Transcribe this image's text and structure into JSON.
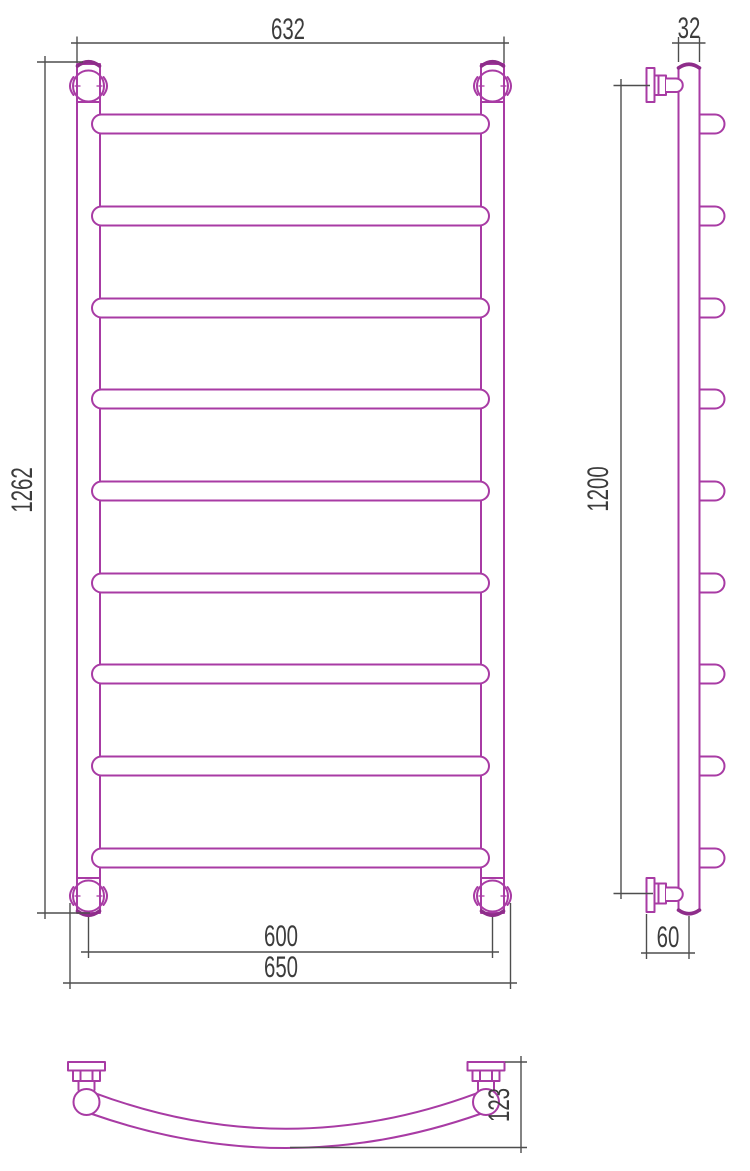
{
  "drawing": {
    "type": "technical-dimension-drawing",
    "rung_count": 9,
    "colors": {
      "outline": "#a83ba4",
      "outline_bold": "#8e2d8a",
      "dimension_line": "#4e4e4e",
      "dimension_text": "#3c3c3c",
      "canvas_bg": "#ffffff"
    },
    "views": {
      "front": {
        "name": "front view",
        "dims": {
          "width_top": "632",
          "height": "1262",
          "width_axes_bottom": "600",
          "width_overall_bottom": "650"
        }
      },
      "side": {
        "name": "side view",
        "dims": {
          "tube_width_top": "32",
          "bracket_span_height": "1200",
          "wall_offset_bottom": "60"
        }
      },
      "top": {
        "name": "top view",
        "dims": {
          "depth": "123"
        }
      }
    }
  }
}
